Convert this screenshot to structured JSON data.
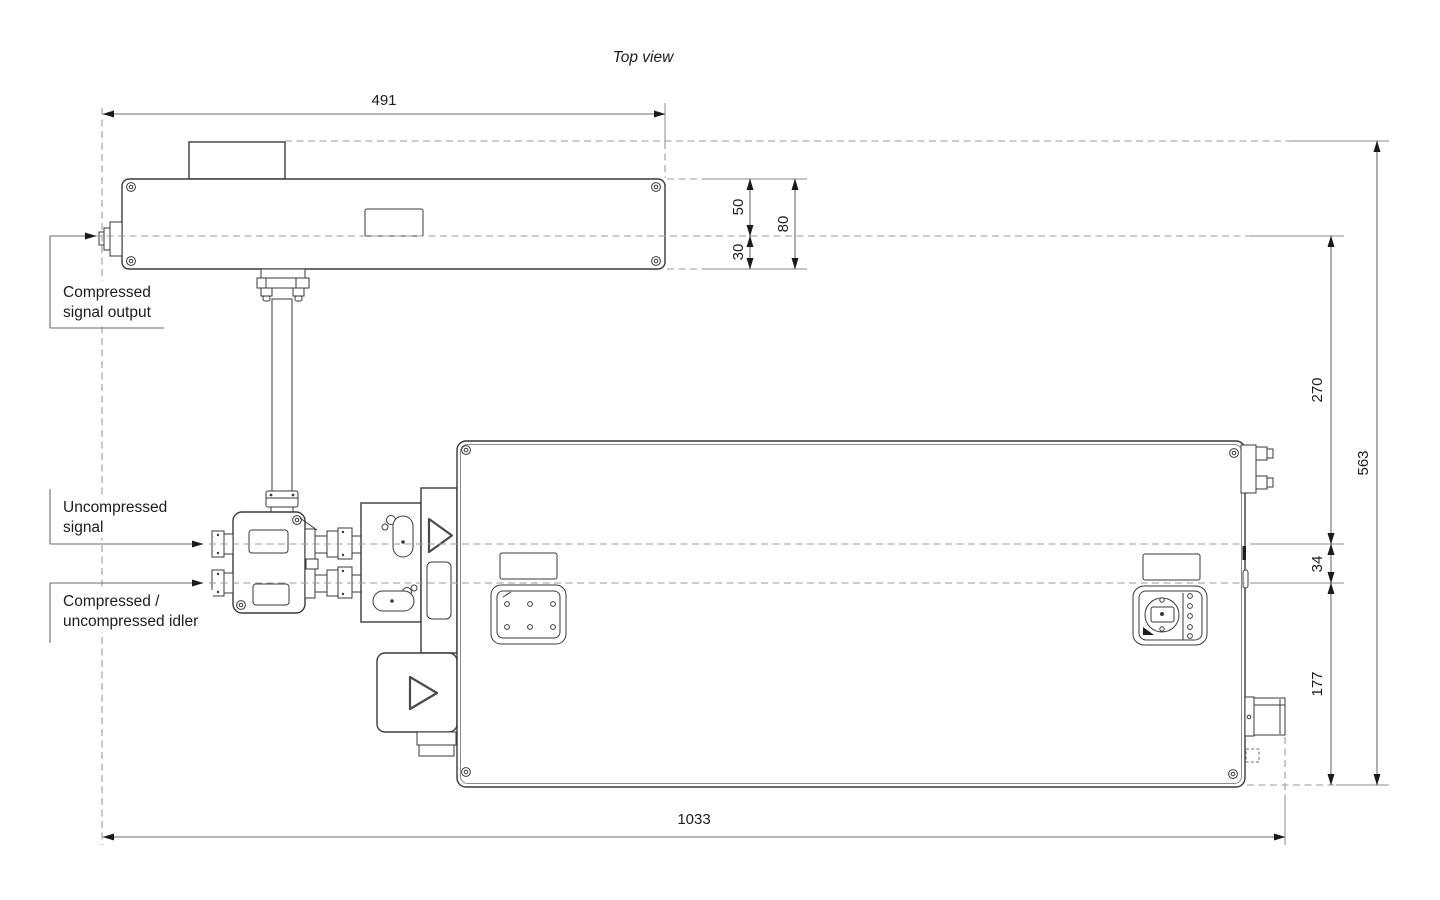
{
  "title": "Top view",
  "labels": {
    "compressed_output": {
      "line1": "Compressed",
      "line2": "signal output"
    },
    "uncompressed": {
      "line1": "Uncompressed",
      "line2": "signal"
    },
    "idler": {
      "line1": "Compressed /",
      "line2": "uncompressed idler"
    }
  },
  "dimensions": {
    "top_unit_width": "491",
    "upper_half": "50",
    "lower_half": "30",
    "top_unit_depth": "80",
    "axis_offset": "270",
    "overall_depth": "563",
    "beam_axis_gap": "34",
    "lower_section": "177",
    "overall_width": "1033"
  },
  "colors": {
    "background": "#ffffff",
    "outline": "#3a3a3a",
    "dimension": "#6b6b6b",
    "centerline": "#9b9b9b",
    "text": "#1c1c1c"
  }
}
